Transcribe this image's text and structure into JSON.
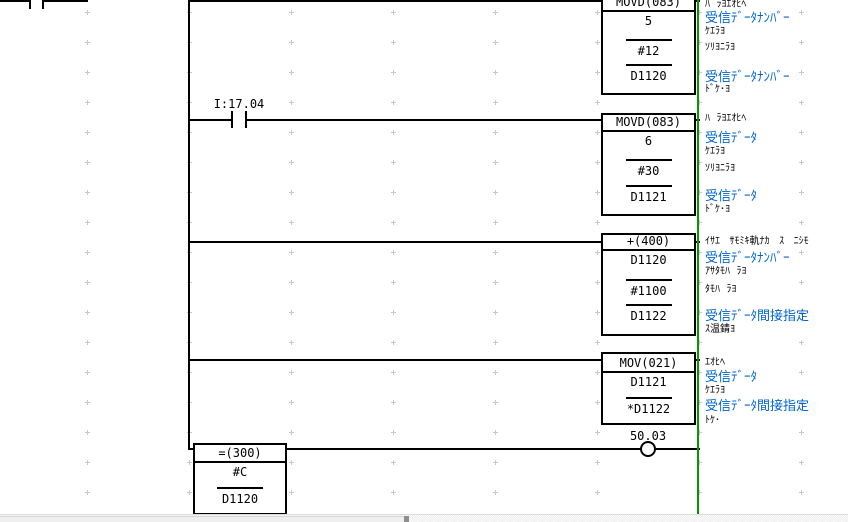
{
  "ladder": {
    "partial_top_contact": {
      "note": "contact cut off at top edge of viewport"
    },
    "input_contact": {
      "label": "I:17.04"
    },
    "output_coil": {
      "label": "50.03"
    },
    "instruction_blocks": [
      {
        "title": "MOVD(083)",
        "operands": [
          "5",
          "#12",
          "D1120"
        ]
      },
      {
        "title": "MOVD(083)",
        "operands": [
          "6",
          "#30",
          "D1121"
        ]
      },
      {
        "title": "+(400)",
        "operands": [
          "D1120",
          "#1100",
          "D1122"
        ]
      },
      {
        "title": "MOV(021)",
        "operands": [
          "D1121",
          "*D1122"
        ]
      },
      {
        "title": "=(300)",
        "operands": [
          "#C",
          "D1120"
        ]
      }
    ],
    "comments": {
      "block1": {
        "title": "ﾊ  ﾗﾖｴｵﾋﾍ",
        "op1_blue": "受信ﾃﾞｰﾀﾅﾝﾊﾞｰ",
        "op1": "ｹｴﾗﾖ",
        "op2": "ｿﾘﾖﾆﾗﾖ",
        "op3_blue": "受信ﾃﾞｰﾀﾅﾝﾊﾞｰ",
        "op3": "ﾄﾞｹ･ﾖ"
      },
      "block2": {
        "title": "ﾊ  ﾗﾖｴｵﾋﾍ",
        "op1_blue": "受信ﾃﾞｰﾀ",
        "op1": "ｹｴﾗﾖ",
        "op2": "ｿﾘﾖﾆﾗﾖ",
        "op3_blue": "受信ﾃﾞｰﾀ",
        "op3": "ﾄﾞｹ･ﾖ"
      },
      "block3": {
        "title": "ｲｻｴ   ｻﾓﾐｷ軌ﾅｶ   ｽ   ﾆｼﾓ",
        "op1_blue": "受信ﾃﾞｰﾀﾅﾝﾊﾞｰ",
        "op1": "ｱｻﾀﾓﾊ  ﾗﾖ",
        "op2": "ﾀﾓﾊ  ﾗﾖ",
        "op3_blue": "受信ﾃﾞｰﾀ間接指定",
        "op3": "ｽ温錆ﾖ"
      },
      "block4": {
        "title": "ｴｵﾋﾍ",
        "op1_blue": "受信ﾃﾞｰﾀ",
        "op1": "ｹｴﾗﾖ",
        "op2_blue": "受信ﾃﾞｰﾀ間接指定",
        "op2": "ﾄｹ･"
      }
    },
    "colors": {
      "comment_blue": "#0066cc",
      "right_bus_green": "#009900",
      "wire_black": "#000000",
      "grid_dot": "#c6cac6"
    }
  }
}
